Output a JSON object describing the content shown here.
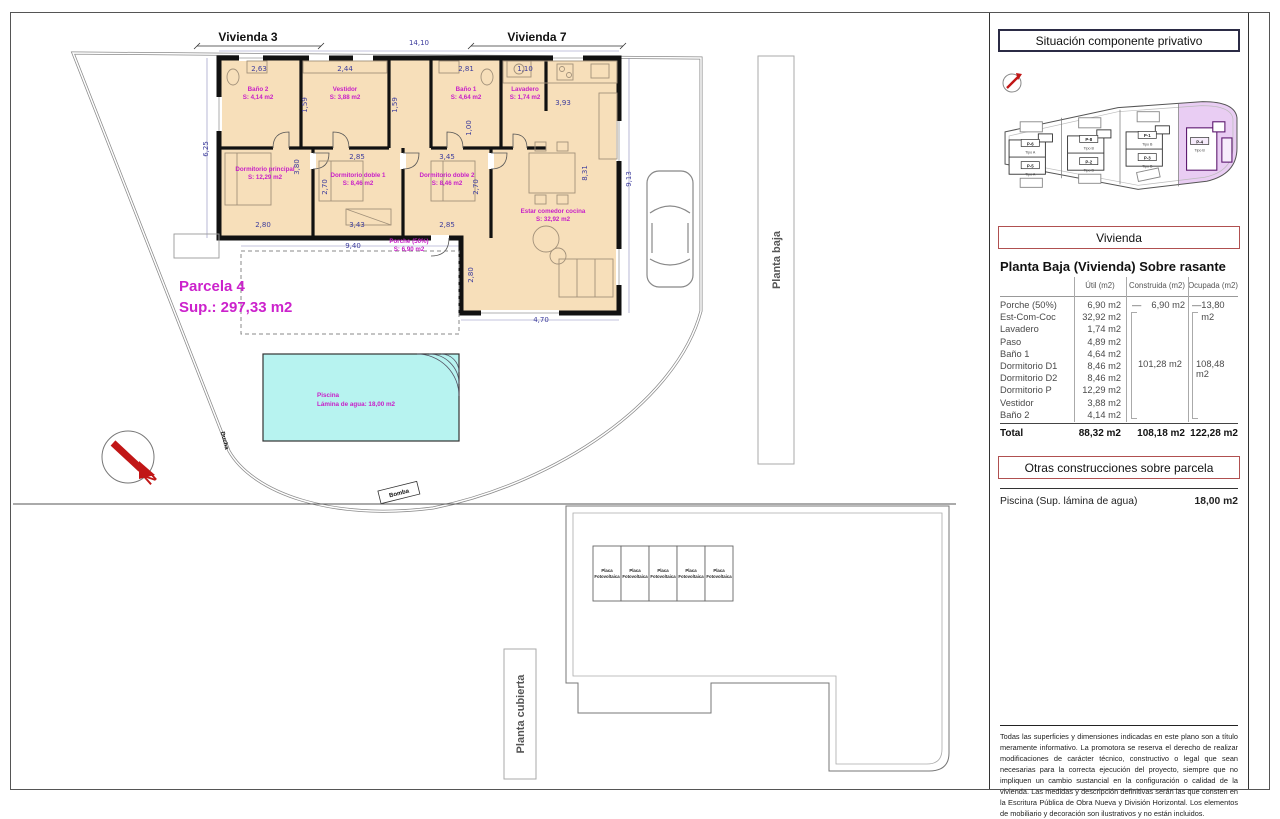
{
  "plan": {
    "vivienda_left": "Vivienda 3",
    "vivienda_right": "Vivienda 7",
    "parcela_title": "Parcela 4",
    "parcela_sup": "Sup.: 297,33 m2",
    "pool_name": "Piscina",
    "pool_area": "Lámina de agua: 18,00 m2",
    "planta_baja": "Planta baja",
    "ducha": "Ducha",
    "bomba": "Bomba",
    "north": "N",
    "dims": [
      {
        "t": "14,10",
        "x": 418,
        "y": 44
      },
      {
        "t": "2,63",
        "x": 258,
        "y": 70
      },
      {
        "t": "2,44",
        "x": 344,
        "y": 70
      },
      {
        "t": "2,81",
        "x": 465,
        "y": 70
      },
      {
        "t": "1,10",
        "x": 524,
        "y": 70
      },
      {
        "t": "3,93",
        "x": 562,
        "y": 104
      },
      {
        "t": "1,59",
        "x": 306,
        "y": 104,
        "r": -90
      },
      {
        "t": "1,59",
        "x": 396,
        "y": 104,
        "r": -90
      },
      {
        "t": "1,00",
        "x": 470,
        "y": 127,
        "r": -90
      },
      {
        "t": "6,25",
        "x": 207,
        "y": 148,
        "r": -90
      },
      {
        "t": "3,80",
        "x": 298,
        "y": 166,
        "r": -90
      },
      {
        "t": "2,85",
        "x": 356,
        "y": 158
      },
      {
        "t": "2,70",
        "x": 326,
        "y": 186,
        "r": -90
      },
      {
        "t": "3,43",
        "x": 356,
        "y": 226
      },
      {
        "t": "3,45",
        "x": 446,
        "y": 158
      },
      {
        "t": "2,70",
        "x": 477,
        "y": 186,
        "r": -90
      },
      {
        "t": "2,85",
        "x": 446,
        "y": 226
      },
      {
        "t": "2,80",
        "x": 262,
        "y": 226
      },
      {
        "t": "9,40",
        "x": 352,
        "y": 247
      },
      {
        "t": "8,31",
        "x": 586,
        "y": 172,
        "r": -90
      },
      {
        "t": "9,13",
        "x": 630,
        "y": 178,
        "r": -90
      },
      {
        "t": "2,80",
        "x": 472,
        "y": 274,
        "r": -90
      },
      {
        "t": "4,70",
        "x": 540,
        "y": 321
      }
    ],
    "rooms": [
      {
        "n": "Baño 2",
        "a": "S: 4,14 m2",
        "x": 257,
        "y": 90
      },
      {
        "n": "Vestidor",
        "a": "S: 3,88 m2",
        "x": 344,
        "y": 90
      },
      {
        "n": "Baño 1",
        "a": "S: 4,64 m2",
        "x": 465,
        "y": 90
      },
      {
        "n": "Lavadero",
        "a": "S: 1,74 m2",
        "x": 524,
        "y": 90
      },
      {
        "n": "Dormitorio principal",
        "a": "S: 12,29 m2",
        "x": 264,
        "y": 170
      },
      {
        "n": "Dormitorio doble 1",
        "a": "S: 8,46 m2",
        "x": 357,
        "y": 176
      },
      {
        "n": "Dormitorio doble 2",
        "a": "S: 8,46 m2",
        "x": 446,
        "y": 176
      },
      {
        "n": "Estar comedor cocina",
        "a": "S: 32,92 m2",
        "x": 552,
        "y": 212
      },
      {
        "n": "Porche (50%)",
        "a": "S: 6,90 m2",
        "x": 408,
        "y": 242
      }
    ]
  },
  "roof": {
    "label": "Planta cubierta",
    "panels": [
      "Placa Fotovoltaica",
      "Placa Fotovoltaica",
      "Placa Fotovoltaica",
      "Placa Fotovoltaica",
      "Placa Fotovoltaica"
    ]
  },
  "panel": {
    "situacion_title": "Situación componente privativo",
    "site_plots": [
      {
        "id": "P-6",
        "tipo": "Tipo A",
        "x": 31,
        "y": 52
      },
      {
        "id": "P-5",
        "tipo": "Tipo A",
        "x": 31,
        "y": 74
      },
      {
        "id": "P-8",
        "tipo": "Tipo B",
        "x": 89,
        "y": 48
      },
      {
        "id": "P-2",
        "tipo": "Tipo B",
        "x": 89,
        "y": 70
      },
      {
        "id": "P-1",
        "tipo": "Tipo B",
        "x": 147,
        "y": 44
      },
      {
        "id": "P-3",
        "tipo": "Tipo B",
        "x": 147,
        "y": 66
      },
      {
        "id": "P-4",
        "tipo": "Tipo B",
        "x": 199,
        "y": 50,
        "hl": true
      }
    ],
    "vivienda_title": "Vivienda",
    "table_title": "Planta Baja (Vivienda) Sobre rasante",
    "table": {
      "headers": [
        "Útil (m2)",
        "Construida (m2)",
        "Ocupada (m2)"
      ],
      "rows": [
        {
          "label": "Porche (50%)",
          "util": "6,90 m2"
        },
        {
          "label": "Est-Com-Coc",
          "util": "32,92 m2"
        },
        {
          "label": "Lavadero",
          "util": "1,74 m2"
        },
        {
          "label": "Paso",
          "util": "4,89 m2"
        },
        {
          "label": "Baño 1",
          "util": "4,64 m2"
        },
        {
          "label": "Dormitorio D1",
          "util": "8,46 m2"
        },
        {
          "label": "Dormitorio D2",
          "util": "8,46 m2"
        },
        {
          "label": "Dormitorio P",
          "util": "12,29 m2"
        },
        {
          "label": "Vestidor",
          "util": "3,88 m2"
        },
        {
          "label": "Baño 2",
          "util": "4,14 m2"
        }
      ],
      "dash": "—",
      "porche_construida": "6,90 m2",
      "porche_ocupada": "13,80 m2",
      "group_construida": "101,28 m2",
      "group_ocupada": "108,48 m2",
      "total_label": "Total",
      "total_util": "88,32 m2",
      "total_construida": "108,18 m2",
      "total_ocupada": "122,28 m2"
    },
    "otras_title": "Otras construcciones sobre parcela",
    "piscina_label": "Piscina (Sup. lámina de agua)",
    "piscina_value": "18,00 m2",
    "disclaimer": "Todas las superficies y dimensiones indicadas en este plano son a título meramente informativo. La promotora se reserva el derecho de realizar modificaciones de carácter técnico, constructivo o legal que sean necesarias para la correcta ejecución del proyecto, siempre que no impliquen un cambio sustancial en la configuración o calidad de la vivienda. Las medidas y descripción definitivas serán las que consten en la Escritura Pública de Obra Nueva y División Horizontal. Los elementos de mobiliario y decoración son ilustrativos y no están incluidos."
  }
}
